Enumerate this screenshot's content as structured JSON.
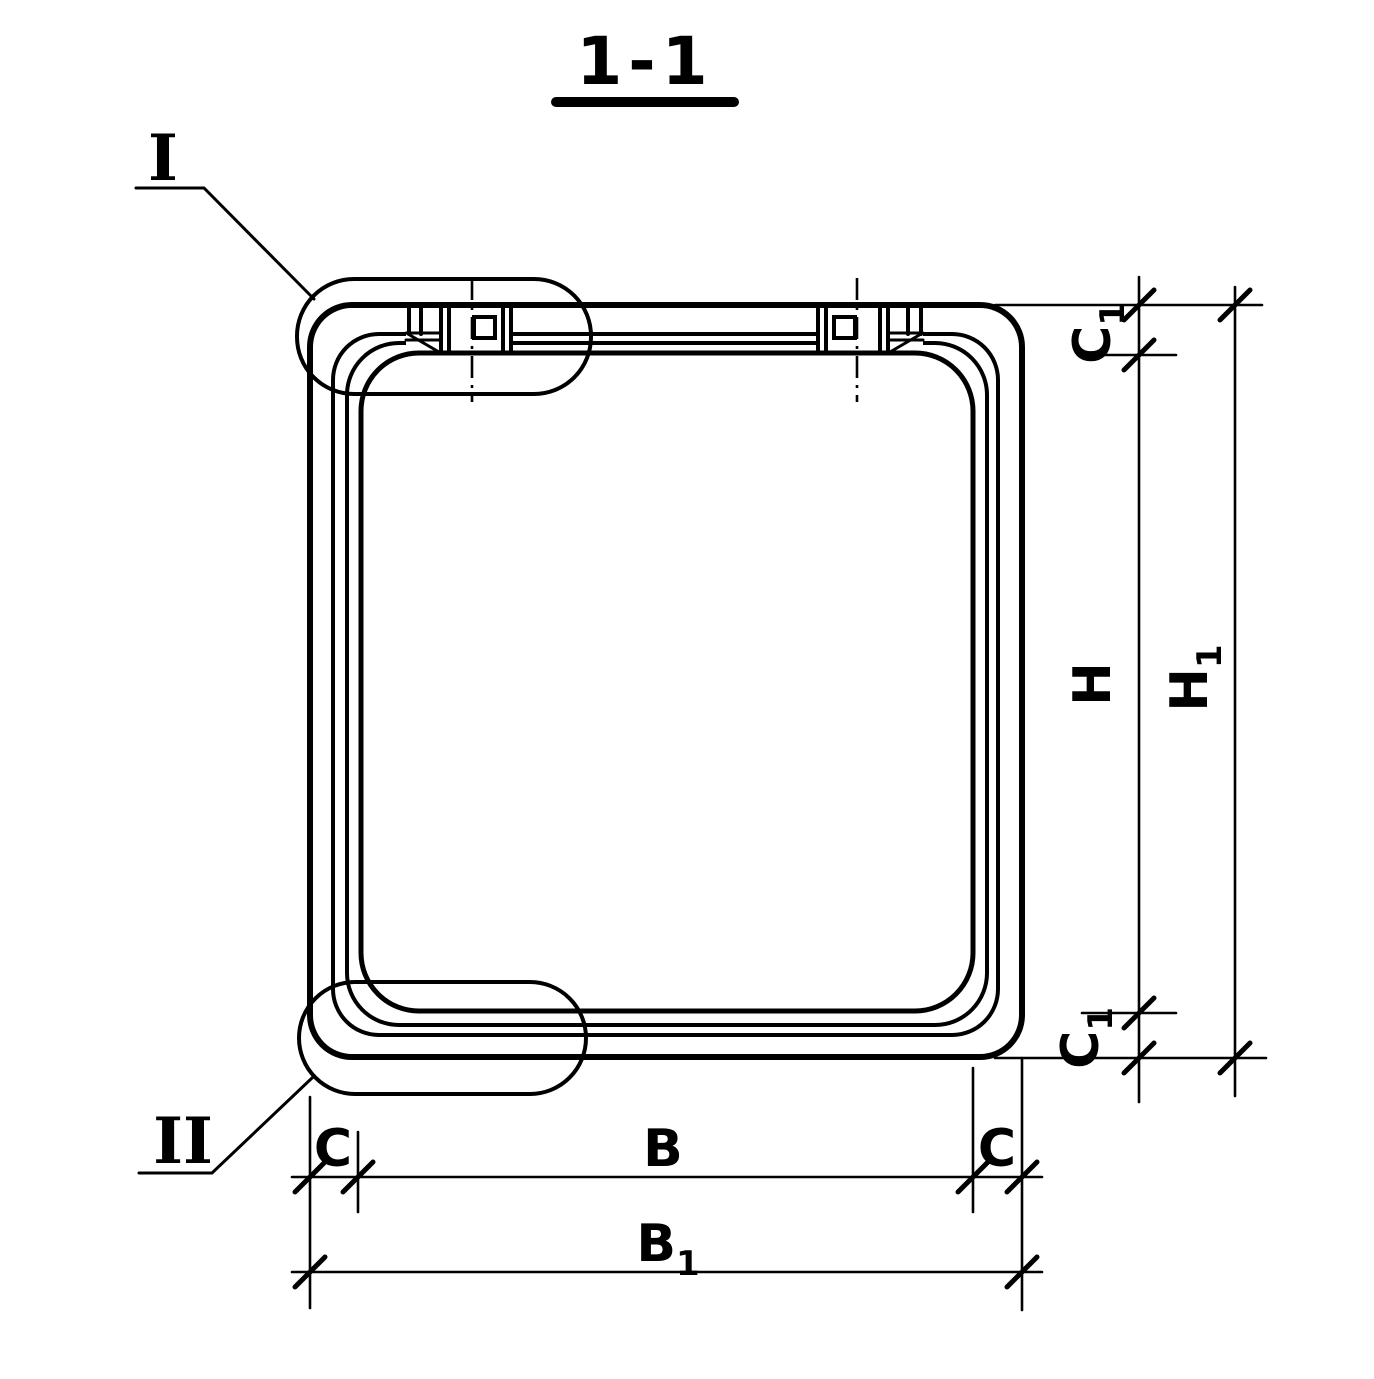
{
  "title": {
    "text": "1-1"
  },
  "callouts": {
    "detail_1": "I",
    "detail_2": "II"
  },
  "dimensions": {
    "c1_top": {
      "main": "C",
      "sub": "1"
    },
    "h": {
      "main": "H",
      "sub": ""
    },
    "h1": {
      "main": "H",
      "sub": "1"
    },
    "c1_bottom": {
      "main": "C",
      "sub": "1"
    },
    "c_left": {
      "main": "C",
      "sub": ""
    },
    "b": {
      "main": "B",
      "sub": ""
    },
    "c_right": {
      "main": "C",
      "sub": ""
    },
    "b1": {
      "main": "B",
      "sub": "1"
    }
  },
  "colors": {
    "ink": "#000000",
    "paper": "#ffffff"
  }
}
